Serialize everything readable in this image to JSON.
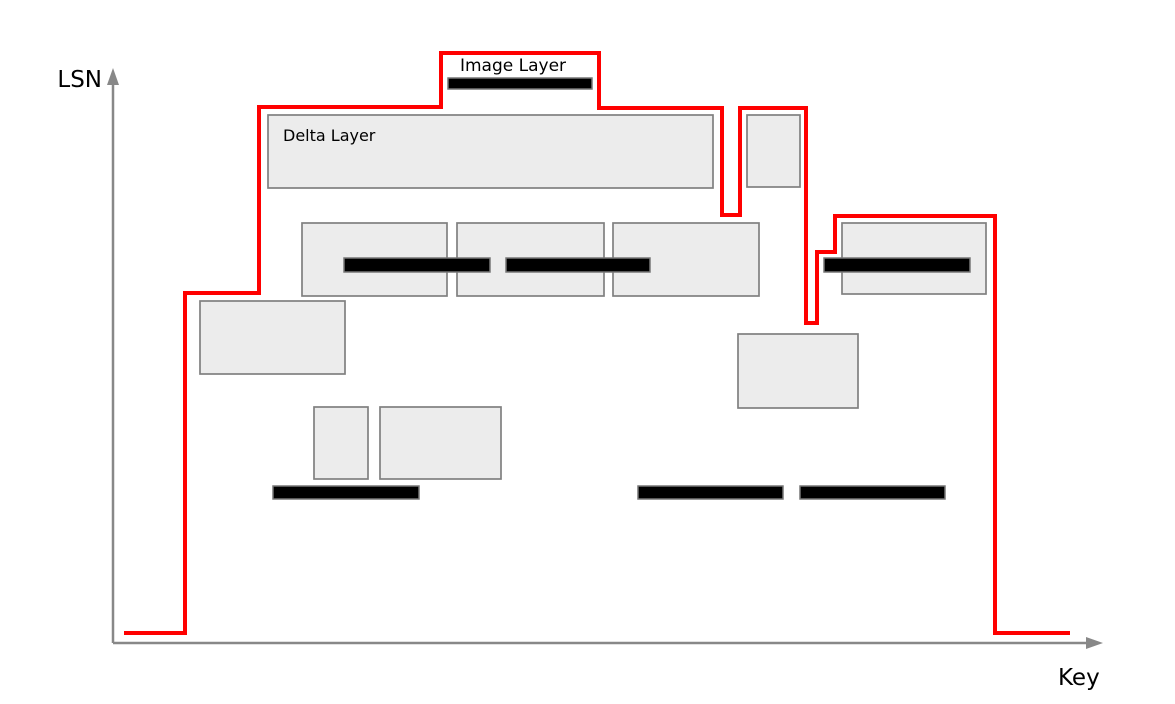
{
  "diagram": {
    "background": "#ffffff",
    "labels": {
      "image_layer": "Image Layer",
      "delta_layer": "Delta Layer",
      "y_axis": "LSN",
      "x_axis": "Key"
    },
    "colors": {
      "red_outline": "#ff0000",
      "box_fill": "#ececec",
      "box_border": "#808080",
      "bar_fill": "#000000",
      "bar_border": "#777777",
      "axis": "#888888",
      "text": "#000000"
    },
    "axes": {
      "origin": [
        113,
        643
      ],
      "y_top": 68,
      "x_right": 1103,
      "y_label_pos": [
        102,
        87
      ],
      "x_label_pos": [
        1058,
        685
      ],
      "label_font_size": 23
    },
    "red_outline_points": [
      [
        124,
        633
      ],
      [
        185,
        633
      ],
      [
        185,
        293
      ],
      [
        259,
        293
      ],
      [
        259,
        107
      ],
      [
        441,
        107
      ],
      [
        441,
        53
      ],
      [
        599,
        53
      ],
      [
        599,
        108
      ],
      [
        722,
        108
      ],
      [
        722,
        215
      ],
      [
        740,
        215
      ],
      [
        740,
        108
      ],
      [
        806,
        108
      ],
      [
        806,
        323
      ],
      [
        817,
        323
      ],
      [
        817,
        252
      ],
      [
        835,
        252
      ],
      [
        835,
        216
      ],
      [
        995,
        216
      ],
      [
        995,
        633
      ],
      [
        1070,
        633
      ]
    ],
    "delta_boxes": [
      {
        "name": "delta-layer-box-main",
        "x": 268,
        "y": 115,
        "w": 445,
        "h": 73
      },
      {
        "name": "delta-box-right-of-main",
        "x": 747,
        "y": 115,
        "w": 53,
        "h": 72
      },
      {
        "name": "delta-box-mid-1",
        "x": 302,
        "y": 223,
        "w": 145,
        "h": 73
      },
      {
        "name": "delta-box-mid-2",
        "x": 457,
        "y": 223,
        "w": 147,
        "h": 73
      },
      {
        "name": "delta-box-mid-3",
        "x": 613,
        "y": 223,
        "w": 146,
        "h": 73
      },
      {
        "name": "delta-box-top-right",
        "x": 842,
        "y": 223,
        "w": 144,
        "h": 71
      },
      {
        "name": "delta-box-left",
        "x": 200,
        "y": 301,
        "w": 145,
        "h": 73
      },
      {
        "name": "delta-box-right-mid",
        "x": 738,
        "y": 334,
        "w": 120,
        "h": 74
      },
      {
        "name": "delta-box-lower-small",
        "x": 314,
        "y": 407,
        "w": 54,
        "h": 72
      },
      {
        "name": "delta-box-lower",
        "x": 380,
        "y": 407,
        "w": 121,
        "h": 72
      }
    ],
    "image_bars": [
      {
        "name": "image-bar-top",
        "x": 448,
        "y": 78,
        "w": 144,
        "h": 11
      },
      {
        "name": "image-bar-mid-1",
        "x": 344,
        "y": 258,
        "w": 146,
        "h": 14
      },
      {
        "name": "image-bar-mid-2",
        "x": 506,
        "y": 258,
        "w": 144,
        "h": 14
      },
      {
        "name": "image-bar-top-right",
        "x": 824,
        "y": 258,
        "w": 146,
        "h": 14
      },
      {
        "name": "image-bar-bottom-1",
        "x": 273,
        "y": 486,
        "w": 146,
        "h": 13
      },
      {
        "name": "image-bar-bottom-2",
        "x": 638,
        "y": 486,
        "w": 145,
        "h": 13
      },
      {
        "name": "image-bar-bottom-3",
        "x": 800,
        "y": 486,
        "w": 145,
        "h": 13
      }
    ],
    "annotations": {
      "image_layer_label": {
        "x": 513,
        "y": 71,
        "font_size": 17,
        "anchor": "middle"
      },
      "delta_layer_label": {
        "x": 283,
        "y": 141,
        "font_size": 16,
        "anchor": "start"
      }
    }
  }
}
